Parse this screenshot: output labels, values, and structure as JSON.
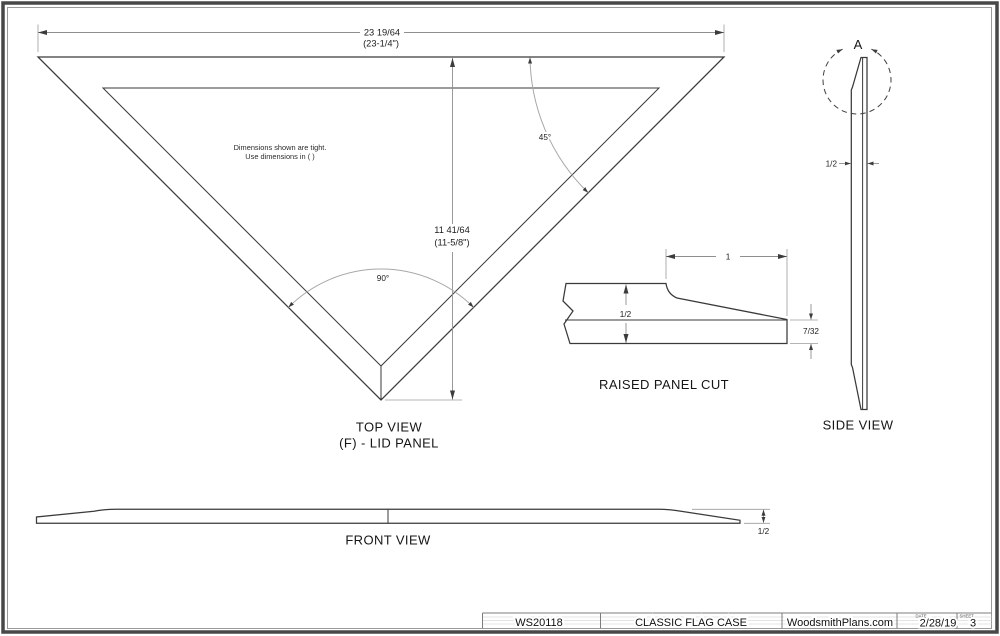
{
  "sheet": {
    "note": {
      "line1": "Dimensions shown are tight.",
      "line2": "Use dimensions in ( )"
    },
    "top_view": {
      "label1": "TOP VIEW",
      "label2": "(F) - LID PANEL",
      "width_dim": "23 19/64",
      "width_dim_paren": "(23-1/4\")",
      "height_dim": "11 41/64",
      "height_dim_paren": "(11-5/8\")",
      "apex_angle": "90°",
      "corner_angle": "45°"
    },
    "raised_panel": {
      "label": "RAISED PANEL CUT",
      "width_dim": "1",
      "thickness_dim": "1/2",
      "tip_dim": "7/32"
    },
    "side_view": {
      "label": "SIDE VIEW",
      "detail": "A",
      "thickness_dim": "1/2"
    },
    "front_view": {
      "label": "FRONT VIEW",
      "thickness_dim": "1/2"
    },
    "title_block": {
      "plan_number": "WS20118",
      "title": "CLASSIC FLAG CASE",
      "website": "WoodsmithPlans.com",
      "date_label": "DATE",
      "date": "2/28/19",
      "sheet_label": "SHEET",
      "sheet_number": "3"
    },
    "colors": {
      "line": "#3a3a3a",
      "dim": "#8f8f8f",
      "arc": "#a8a8a8",
      "border": "#484848"
    }
  }
}
